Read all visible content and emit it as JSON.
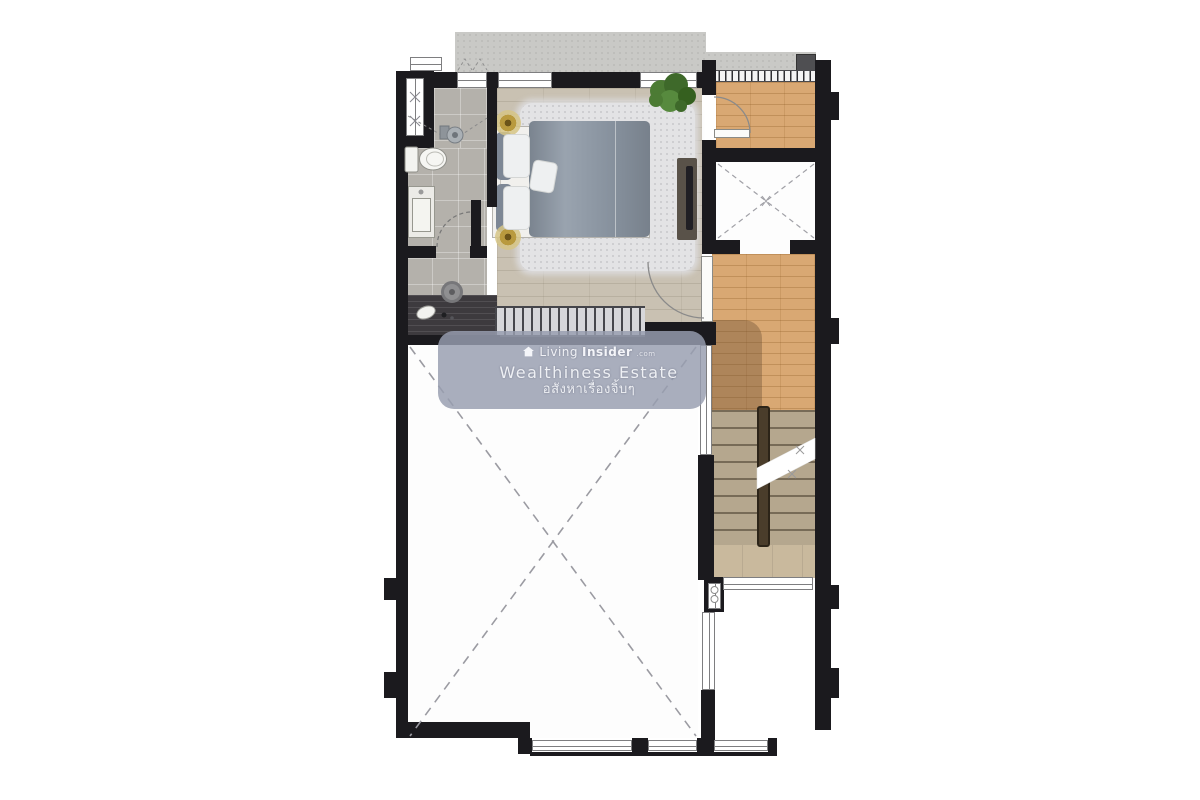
{
  "watermark": {
    "brand": {
      "prefix": "Living",
      "suffix": "Insider",
      "domain": ".com"
    },
    "tagline": "Wealthiness Estate",
    "tagline_thai": "อสังหาเรื่องจิ้บๆ"
  },
  "plan": {
    "kind": "residential floor plan (top-down view)",
    "rooms": [
      "bedroom",
      "bathroom",
      "dressing-area",
      "balcony-deck",
      "elevator-shaft",
      "stair-hall",
      "staircase",
      "stair-landing",
      "double-height-void",
      "ac-ledge",
      "concrete-ledge"
    ],
    "furniture": [
      "double-bed",
      "area-rug",
      "bedside-lamp-left",
      "bedside-lamp-right",
      "plant",
      "tv-console",
      "dressing-desk",
      "stool",
      "desk-lamp",
      "toilet",
      "vanity-sink",
      "shower"
    ],
    "symbols": [
      "void-dashed-cross",
      "shaft-dashed-cross",
      "door-swing-arcs",
      "stair-break-line",
      "void-railing",
      "window-strips",
      "louver-vent"
    ]
  },
  "colors": {
    "wall": "#1b1a1e",
    "bedroomWood": "#c9c1b2",
    "deckWood": "#d9a873",
    "stairWood": "#b5a78e",
    "landingWood": "#c9b99d",
    "tile": "#b4b1ab",
    "concrete": "#c9c9c6",
    "voidFloor": "#fdfdfd",
    "duvet": "#8e99a6",
    "pillowGray": "#7d8795",
    "bedWhite": "#f1f0ed",
    "rug": "#e3e3e5",
    "lampGold": "#b99a3e",
    "console": "#595249",
    "tvBlack": "#201f24",
    "desk": "#3d3a3e",
    "stool": "#8f8f91",
    "railingBand": "#d7d7da",
    "shadowPatch": "rgba(104,76,50,0.38)",
    "wmBg": "rgba(152,157,176,0.83)",
    "wmText": "#f4f5f9"
  }
}
